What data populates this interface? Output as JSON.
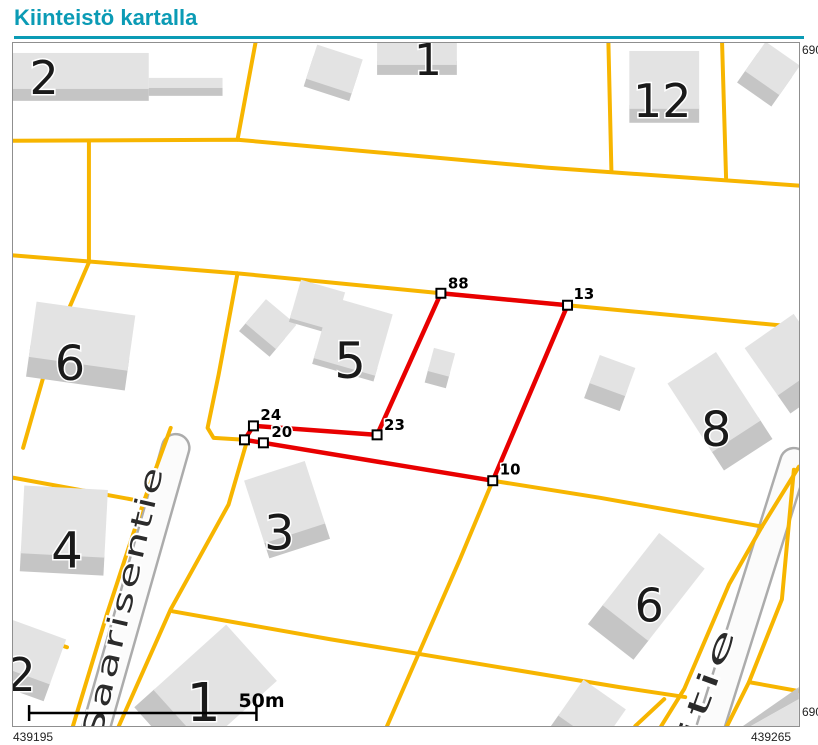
{
  "title": "Kiinteistö kartalla",
  "colors": {
    "accent": "#0B9BB5",
    "road_line": "#F7B500",
    "parcel": "#E80000",
    "building_top": "#E3E3E3",
    "building_side": "#C5C5C5",
    "road_casing": "#ACACAC",
    "road_fill": "#FBFBFB",
    "street_text": "#2B2B2B",
    "frame": "#8F8F8F"
  },
  "coordinates": {
    "bottom_left": "439195",
    "bottom_right": "439265",
    "top_right": "690",
    "right_bottom": "690"
  },
  "scale_bar": {
    "label": "50m"
  },
  "streets": [
    {
      "name": "Saarisentie"
    },
    {
      "name": "itie"
    }
  ],
  "buildings": [
    {
      "label": "2"
    },
    {
      "label": "1"
    },
    {
      "label": "12"
    },
    {
      "label": "6"
    },
    {
      "label": "5"
    },
    {
      "label": "8"
    },
    {
      "label": "4"
    },
    {
      "label": "3"
    },
    {
      "label": "6"
    },
    {
      "label": "2"
    },
    {
      "label": "1"
    }
  ],
  "parcel_points": [
    {
      "label": "88"
    },
    {
      "label": "13"
    },
    {
      "label": "10"
    },
    {
      "label": "23"
    },
    {
      "label": "24"
    },
    {
      "label": "20"
    }
  ]
}
